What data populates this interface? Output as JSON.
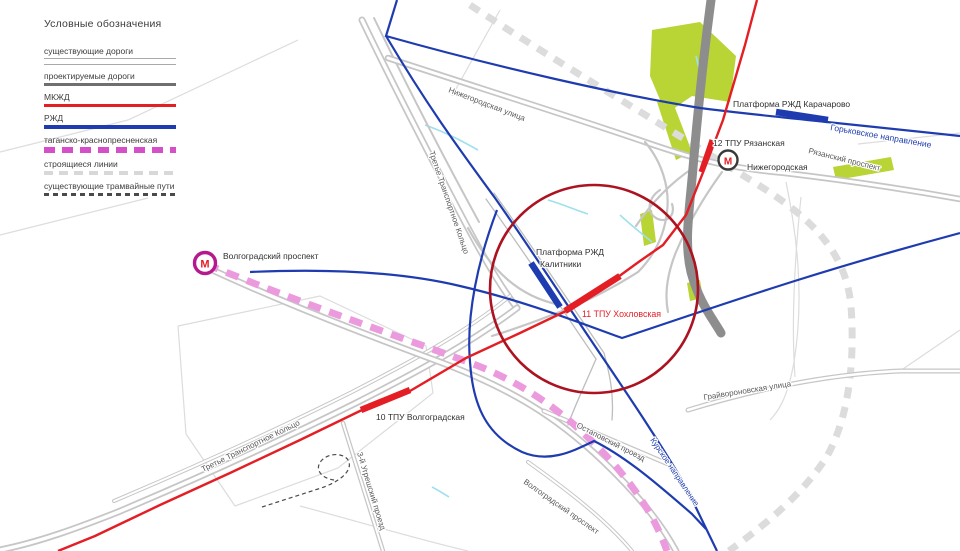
{
  "legend": {
    "title": "Условные обозначения",
    "items": [
      {
        "label": "существующие дороги"
      },
      {
        "label": "проектируемые дороги"
      },
      {
        "label": "МКЖД"
      },
      {
        "label": "РЖД"
      },
      {
        "label": "таганско-краснопресненская"
      },
      {
        "label": "строящиеся линии"
      },
      {
        "label": "существующие трамвайные пути"
      }
    ]
  },
  "colors": {
    "existing_road": "#a9a9a9",
    "projected_road": "#6f6f6f",
    "mkzhd": "#e31e24",
    "rzhd": "#1e3cb0",
    "tagansko": "#d44fc8",
    "construction": "#dcdcdc",
    "tram": "#4a4a4a",
    "focus_circle": "#ac1220",
    "park_green": "#b9d435",
    "water": "#9fe0ec"
  },
  "map": {
    "metro_letter": "М",
    "stations": {
      "karacharovo": "Платформа РЖД Карачарово",
      "tpu12": "12 ТПУ Рязанская",
      "nizhegorodskaya": "Нижегородская",
      "kalitniki_line1": "Платформа РЖД",
      "kalitniki_line2": "Калитники",
      "tpu11": "11 ТПУ Хохловская",
      "tpu10": "10 ТПУ Волгоградская",
      "volgogradsky_metro": "Волгоградский проспект"
    },
    "roads": {
      "gorkovskoye": "Горьковское направление",
      "kurskoye": "Курское направление",
      "ryazansky": "Рязанский проспект",
      "nizhegorodskaya_ulitsa": "Нижегородская улица",
      "ttk_upper": "Третье Транспортное Кольцо",
      "ttk_lower": "Третье Транспортное Кольцо",
      "volgogradsky_prospekt": "Волгоградский проспект",
      "ostapovsky": "Остаповский проезд",
      "graivoronovskaya": "Грайвороновская улица",
      "ugreshsky": "3-й Угрешский проезд"
    }
  }
}
